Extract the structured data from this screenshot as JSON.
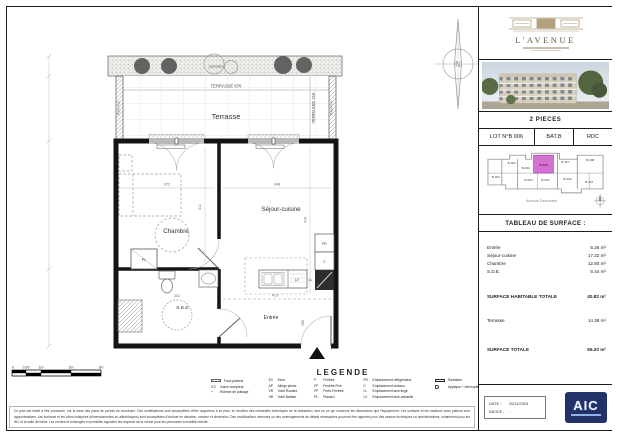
{
  "plan": {
    "labels": {
      "jardiniere": "Jardinière",
      "terrasse_dim_w": "TERRASSE 670",
      "terrasse_dim_h": "TERRASSE 215",
      "pare_vue_left": "Pare-Vue",
      "pare_vue_right": "Pare-Vue",
      "terrasse": "Terrasse",
      "chambre": "Chambre",
      "sejour": "Séjour-cuisine",
      "sde": "S.D.E.",
      "entree": "Entrée",
      "north": "N"
    },
    "dims": {
      "chambre_w": "372",
      "chambre_h": "411",
      "sejour_w": "348",
      "sejour_h": "473",
      "entree_w": "413",
      "entree_h": "150",
      "sde_w": "202"
    },
    "fixtures": {
      "fr": "FR",
      "c": "C",
      "lv": "LV",
      "ll": "LL",
      "pl": "PL"
    }
  },
  "scalebar": {
    "ticks": [
      "0",
      "0.50",
      "1m",
      "2m",
      "3m"
    ]
  },
  "legend": {
    "title": "LEGENDE",
    "columns": [
      {
        "items": [
          {
            "abbr": "",
            "label": "Faux-plafond"
          },
          {
            "abbr": "GC",
            "label": "Gaine-compteur"
          },
          {
            "abbr": "+",
            "label": "Robinet de puisage"
          }
        ]
      },
      {
        "items": [
          {
            "abbr": "EV",
            "label": "Evier"
          },
          {
            "abbr": "AP",
            "label": "Allège pleine"
          },
          {
            "abbr": "VR",
            "label": "Volet Roulant"
          },
          {
            "abbr": "VB",
            "label": "Volet Battant"
          }
        ]
      },
      {
        "items": [
          {
            "abbr": "F",
            "label": "Fenêtre"
          },
          {
            "abbr": "FF",
            "label": "Fenêtre Fixe"
          },
          {
            "abbr": "PF",
            "label": "Porte-Fenêtre"
          },
          {
            "abbr": "PL",
            "label": "Placard"
          }
        ]
      },
      {
        "items": [
          {
            "abbr": "FR",
            "label": "Emplacement réfrigérateur"
          },
          {
            "abbr": "C",
            "label": "Emplacement cuisson"
          },
          {
            "abbr": "LL",
            "label": "Emplacement lave-linge"
          },
          {
            "abbr": "LV",
            "label": "Emplacement lave-vaisselle"
          }
        ]
      },
      {
        "items": [
          {
            "abbr": "",
            "label": "Radiateur"
          },
          {
            "abbr": "",
            "label": "Applique + interrupteur"
          }
        ]
      }
    ]
  },
  "disclaimer": "Ce plan est établi à titre provisoire, sur la base des plans de permis de construire. Des modifications sont susceptibles d'être apportées à ce plan, en fonction des nécessités techniques de la réalisation, tant en ce qui concerne les dimensions que l'équipement. Les surfaces et les hauteurs sous plafond sont approximatives. Les surfaces et les côtes indiquées (dimensionnelles ou altimétriques) sont susceptibles d'évoluer en situation, nombre et dimension. Des modifications mineures ou des aménagements de détails nécessaires pourront être apportés pour des raisons techniques ou administratives, notamment pour les WC et la salle de bains. Les cercles et rectangles en pointillés signalent les respects de la norme pour les personnes à mobilité réduite.",
  "title_block": {
    "brand": {
      "name": "L'AVENUE"
    },
    "type_label": "2 PIECES",
    "lot": {
      "number": "LOT N°B 006",
      "building": "BAT.B",
      "floor": "RDC"
    },
    "key_plan": {
      "street": "Avenue Descartes",
      "highlight_unit": "B-006",
      "highlight_color": "#cf63cf",
      "units": [
        "B-002",
        "B-003",
        "B-006",
        "B-007",
        "B-008",
        "B-001",
        "B-004",
        "B-005",
        "B-009",
        "B-010"
      ]
    },
    "surface_table": {
      "title": "TABLEAU DE SURFACE :",
      "rows": [
        {
          "label": "Entrée",
          "value": "5.26 m²"
        },
        {
          "label": "Séjour-cuisine",
          "value": "17.32 m²"
        },
        {
          "label": "Chambre",
          "value": "12.80 m²"
        },
        {
          "label": "S.D.E.",
          "value": "5.44 m²"
        }
      ],
      "habitable": {
        "label": "SURFACE HABITABLE TOTALE",
        "value": "40.82 m²"
      },
      "terrasse": {
        "label": "Terrasse",
        "value": "14.38 m²"
      },
      "total": {
        "label": "SURFACE TOTALE",
        "value": "55.20 m²"
      }
    },
    "footer": {
      "date_label": "DATE :",
      "date": "20/11/2024",
      "indice_label": "INDICE :",
      "indice": "-",
      "logo_text": "AIC"
    }
  }
}
